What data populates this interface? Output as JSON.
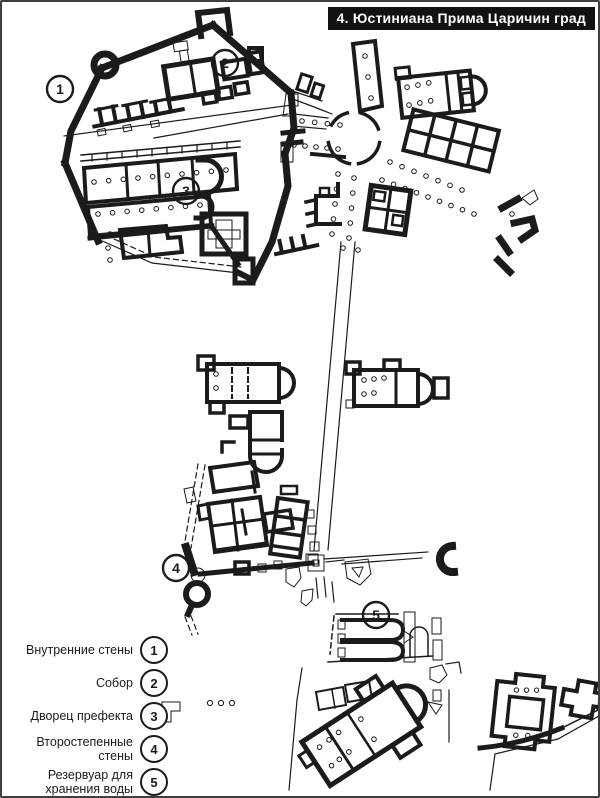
{
  "page": {
    "paper_color": "#ffffff",
    "ink_color": "#1b1b1b",
    "border_color": "#3f3f3f"
  },
  "title": {
    "text": "4. Юстиниана Прима Царичин град",
    "bg": "#111111",
    "color": "#ffffff"
  },
  "legend": {
    "items": [
      {
        "num": "1",
        "lines": [
          "Внутренние стены"
        ]
      },
      {
        "num": "2",
        "lines": [
          "Собор"
        ]
      },
      {
        "num": "3",
        "lines": [
          "Дворец префекта"
        ]
      },
      {
        "num": "4",
        "lines": [
          "Второстепенные",
          "стены"
        ]
      },
      {
        "num": "5",
        "lines": [
          "Резервуар для",
          "хранения воды"
        ]
      }
    ]
  },
  "map": {
    "markers": [
      {
        "num": "1",
        "x": 58,
        "y": 87
      },
      {
        "num": "2",
        "x": 223,
        "y": 61
      },
      {
        "num": "3",
        "x": 184,
        "y": 189
      },
      {
        "num": "4",
        "x": 174,
        "y": 566
      },
      {
        "num": "5",
        "x": 374,
        "y": 613
      }
    ]
  }
}
